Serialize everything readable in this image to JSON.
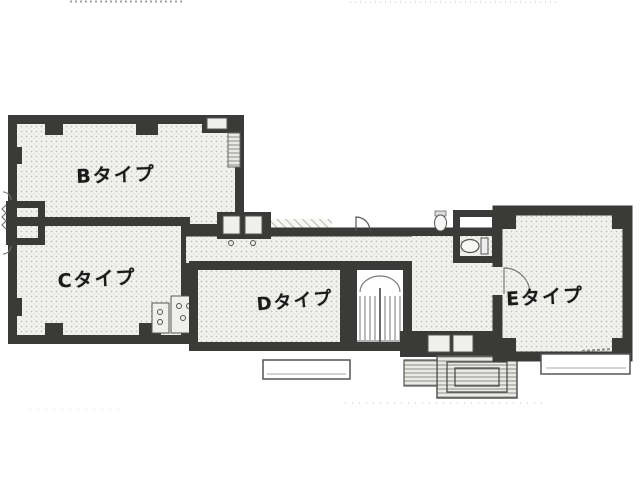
{
  "plan": {
    "rooms": [
      {
        "id": "b",
        "label": "Bタイプ"
      },
      {
        "id": "c",
        "label": "Cタイプ"
      },
      {
        "id": "d",
        "label": "Dタイプ"
      },
      {
        "id": "e",
        "label": "Eタイプ"
      }
    ],
    "colors": {
      "wall": "#3a3a38",
      "floor_bg": "#f3f3f0",
      "floor_dot": "#c6c6c2",
      "line": "#555555",
      "paper": "#ffffff",
      "ink": "#1a1a1a"
    }
  }
}
